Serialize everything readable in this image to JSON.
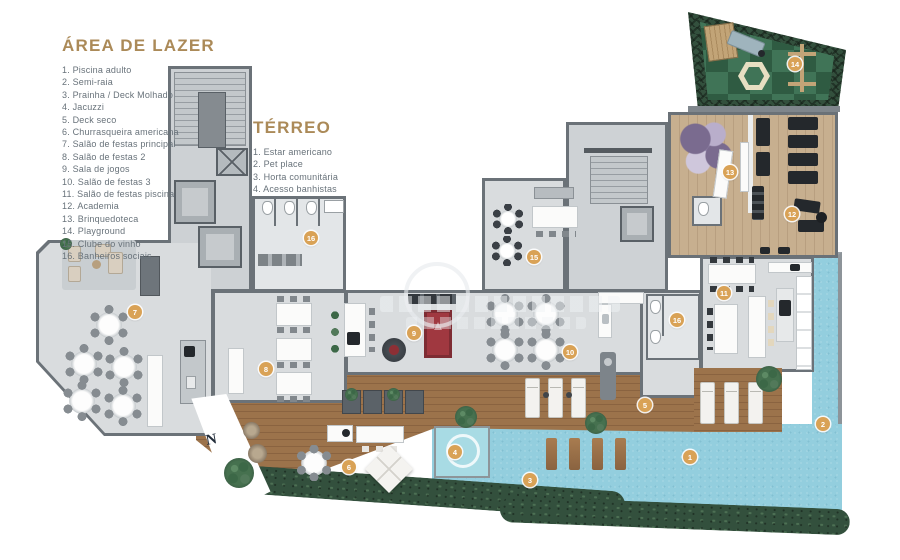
{
  "legend_lazer": {
    "title": "ÁREA DE LAZER",
    "items": [
      "1. Piscina adulto",
      "2. Semi-raia",
      "3. Prainha / Deck Molhado",
      "4. Jacuzzi",
      "5. Deck seco",
      "6. Churrasqueira americana",
      "7. Salão de festas principal",
      "8. Salão de festas 2",
      "9. Sala de jogos",
      "10. Salão de festas 3",
      "11. Salão de festas piscina",
      "12. Academia",
      "13. Brinquedoteca",
      "14. Playground",
      "15. Clube do vinho",
      "16. Banheiros sociais"
    ]
  },
  "legend_terreo": {
    "title": "TÉRREO",
    "items": [
      "1. Estar americano",
      "2. Pet place",
      "3. Horta comunitária",
      "4. Acesso banhistas"
    ]
  },
  "markers": {
    "labels": [
      "1",
      "2",
      "3",
      "4",
      "5",
      "6",
      "7",
      "8",
      "9",
      "10",
      "11",
      "12",
      "13",
      "14",
      "15",
      "16",
      "16"
    ]
  },
  "podium_logo": "N",
  "colors": {
    "accent_gold": "#ab8a58",
    "marker_fill": "#d9a256",
    "pool_blue": "#93cede",
    "deck_wood": "#9c734b",
    "gym_wood": "#c7af8f",
    "lawn_dark": "#2f5b42",
    "lawn_light": "#407457",
    "floor_gray": "#d9dcde",
    "wall_gray": "#6b7278",
    "pool_table_red": "#a03840"
  }
}
